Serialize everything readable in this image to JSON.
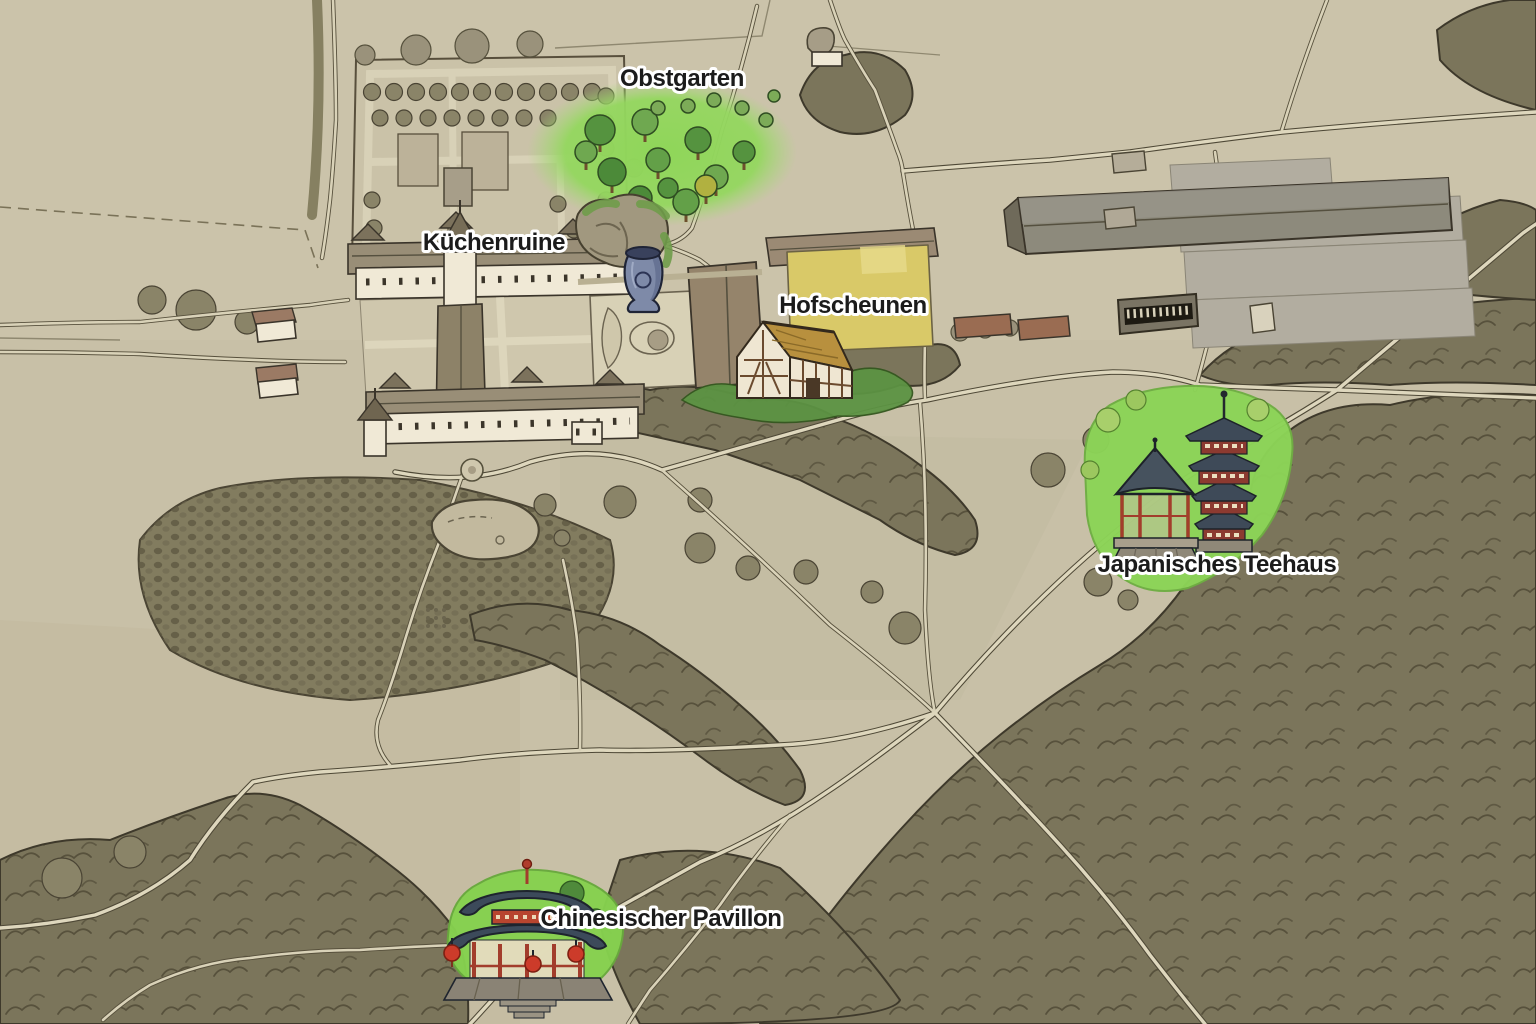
{
  "labels": {
    "obstgarten": {
      "text": "Obstgarten"
    },
    "kuechenruine": {
      "text": "Küchenruine"
    },
    "hofscheunen": {
      "text": "Hofscheunen"
    },
    "teehaus": {
      "text": "Japanisches Teehaus"
    },
    "pavillon": {
      "text": "Chinesischer Pavillon"
    }
  },
  "landmarks": {
    "obstgarten": {
      "icon": "orchard-trees-icon",
      "description": "orchard of fruit trees on bright green"
    },
    "kuechenruine": {
      "icon": "urn-vase-icon",
      "description": "blue garden urn beside rocky ruin grotto"
    },
    "hofscheunen": {
      "icon": "half-timbered-barn-icon",
      "description": "thatched half-timbered farm barn"
    },
    "teehaus": {
      "icon": "pagoda-and-tea-pavilion-icon",
      "description": "red pagoda and tea pavilion on green lawn"
    },
    "pavillon": {
      "icon": "chinese-pavilion-icon",
      "description": "two-roofed Chinese pavilion with red lanterns"
    }
  },
  "colors": {
    "parchment": "#c8c0a7",
    "forest": "#7b755b",
    "road_fill": "#ded7bd",
    "road_edge": "#4e4836",
    "highlight_green": "#8cd457",
    "field_yellow": "#d9c968",
    "label_text": "#1b1b1b",
    "label_outline": "#ffffff",
    "vase_blue": "#7e8aa8",
    "pagoda_red": "#8c3a30",
    "roof_slate": "#3c4a5a"
  }
}
